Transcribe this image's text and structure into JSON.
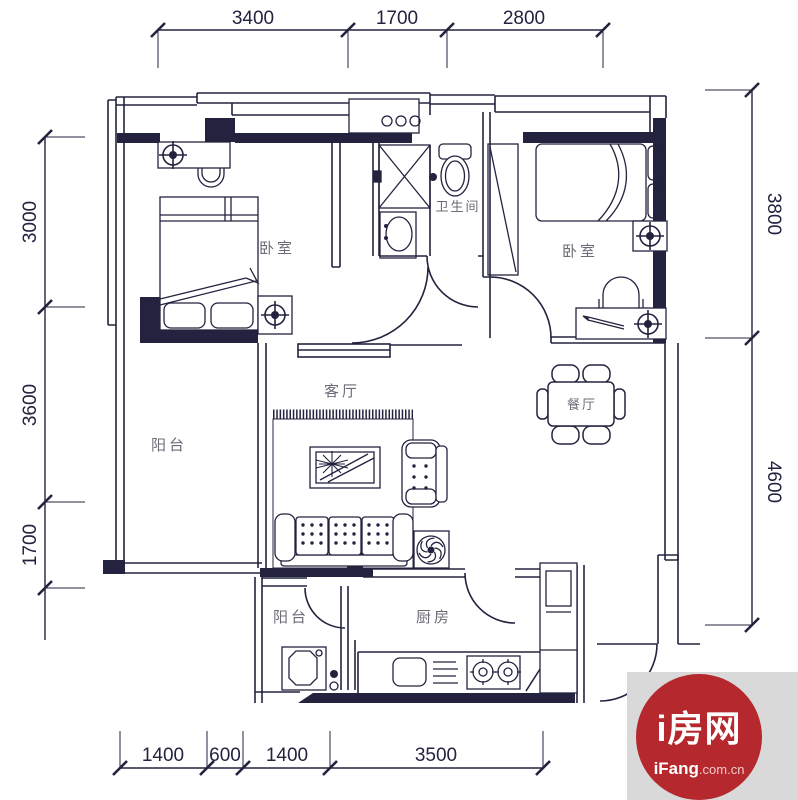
{
  "plan": {
    "ink": "#23233f",
    "label_color": "#6b6b78",
    "rooms": {
      "bedroom_left": "卧室",
      "bathroom": "卫生间",
      "bedroom_right": "卧室",
      "living": "客厅",
      "dining": "餐厅",
      "balcony_left": "阳台",
      "balcony_bottom": "阳台",
      "kitchen": "厨房"
    },
    "dims": {
      "top_1": "3400",
      "top_2": "1700",
      "top_3": "2800",
      "left_1": "3000",
      "left_2": "3600",
      "left_3": "1700",
      "right_1": "3800",
      "right_2": "4600",
      "bottom_1": "1400",
      "bottom_2": "600",
      "bottom_3": "1400",
      "bottom_4": "3500"
    }
  },
  "watermark": {
    "brand": "i房网",
    "site_bold": "iFang",
    "site_suffix": ".com.cn",
    "circle_color": "#b5282d",
    "panel_color": "#d9d9d9"
  }
}
